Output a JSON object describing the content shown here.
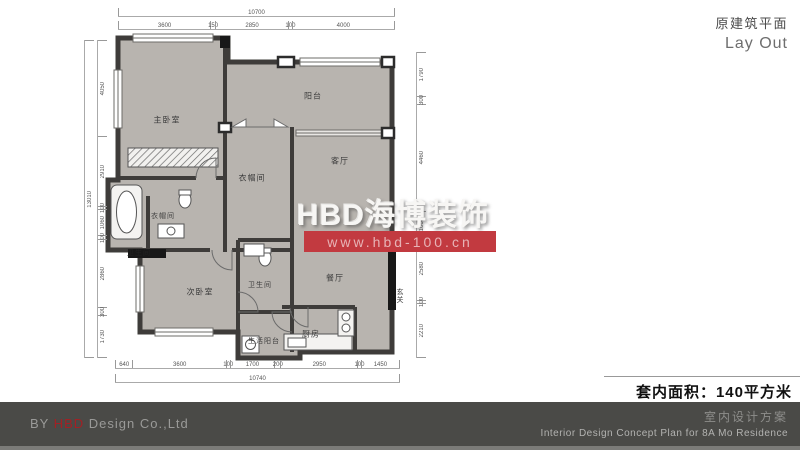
{
  "header": {
    "title_cn": "原建筑平面",
    "title_en": "Lay Out"
  },
  "watermark": {
    "brand": "HBD海博装饰",
    "url": "www.hbd-100.cn",
    "band_color": "#c23a40"
  },
  "area_note": {
    "text": "套内面积：140平方米"
  },
  "footer": {
    "by_prefix": "BY ",
    "brand": "HBD",
    "company": " Design Co.,Ltd",
    "title_cn": "室内设计方案",
    "title_en": "Interior Design Concept Plan for 8A Mo Residence",
    "bar_color": "#4a4a47",
    "brand_color": "#a32024"
  },
  "plan": {
    "colors": {
      "wall": "#3e3c3a",
      "floor": "#b8b4af"
    },
    "rooms": [
      {
        "key": "master-bedroom",
        "label": "主卧室"
      },
      {
        "key": "walkin-closet",
        "label": "衣帽间"
      },
      {
        "key": "balcony",
        "label": "阳台"
      },
      {
        "key": "living-room",
        "label": "客厅"
      },
      {
        "key": "closet-small",
        "label": "衣帽间"
      },
      {
        "key": "bathroom-left",
        "label": "卫生间"
      },
      {
        "key": "second-bedroom",
        "label": "次卧室"
      },
      {
        "key": "bathroom-center",
        "label": "卫生间"
      },
      {
        "key": "dining-room",
        "label": "餐厅"
      },
      {
        "key": "kitchen",
        "label": "厨房"
      },
      {
        "key": "service-balcony",
        "label": "生活阳台"
      },
      {
        "key": "entry-hall",
        "label": "玄关"
      }
    ],
    "dims": {
      "top_total": [
        10700
      ],
      "top_segments": [
        3600,
        150,
        2850,
        100,
        4000
      ],
      "bottom_segments": [
        640,
        3600,
        100,
        1700,
        200,
        2950,
        100,
        1450
      ],
      "bottom_total": [
        10740
      ],
      "left_total": [
        13010
      ],
      "left_segments": [
        4050,
        2910,
        100,
        1060,
        100,
        2860,
        300,
        1730
      ],
      "right_segments": [
        1790,
        300,
        4460,
        1060,
        2580,
        100,
        2210
      ]
    }
  }
}
